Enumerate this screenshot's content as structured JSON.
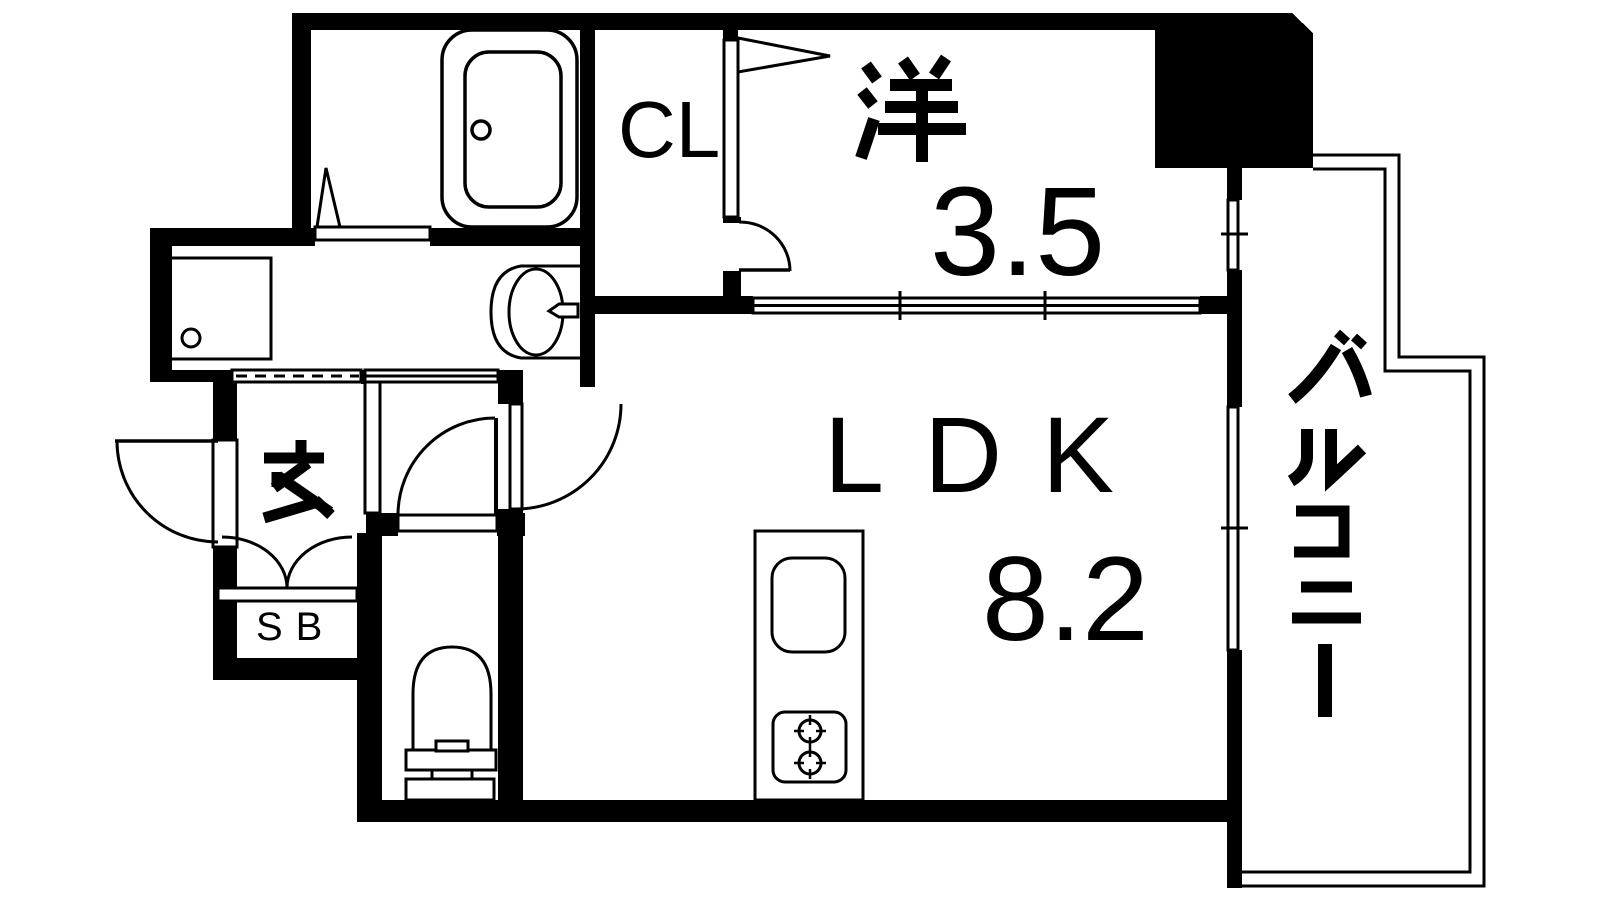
{
  "colors": {
    "background": "#ffffff",
    "ink": "#000000"
  },
  "rooms": {
    "western": {
      "label": "洋",
      "size": "3.5"
    },
    "ldk": {
      "label": "LDK",
      "size": "8.2"
    },
    "closet": {
      "label": "CL"
    },
    "entrance": {
      "label": "玄"
    },
    "shoe_box": {
      "label": "SB"
    },
    "balcony": {
      "label": "バルコニー"
    }
  },
  "fixtures": {
    "bathtub": "bathtub",
    "washing_machine_pan": "washing-machine-pan",
    "wash_basin": "wash-basin-with-counter",
    "toilet": "toilet",
    "kitchen_counter": "kitchen-counter-with-sink",
    "stove": "two-burner-stove",
    "shoe_cabinet": "shoe-cabinet-double-doors"
  }
}
